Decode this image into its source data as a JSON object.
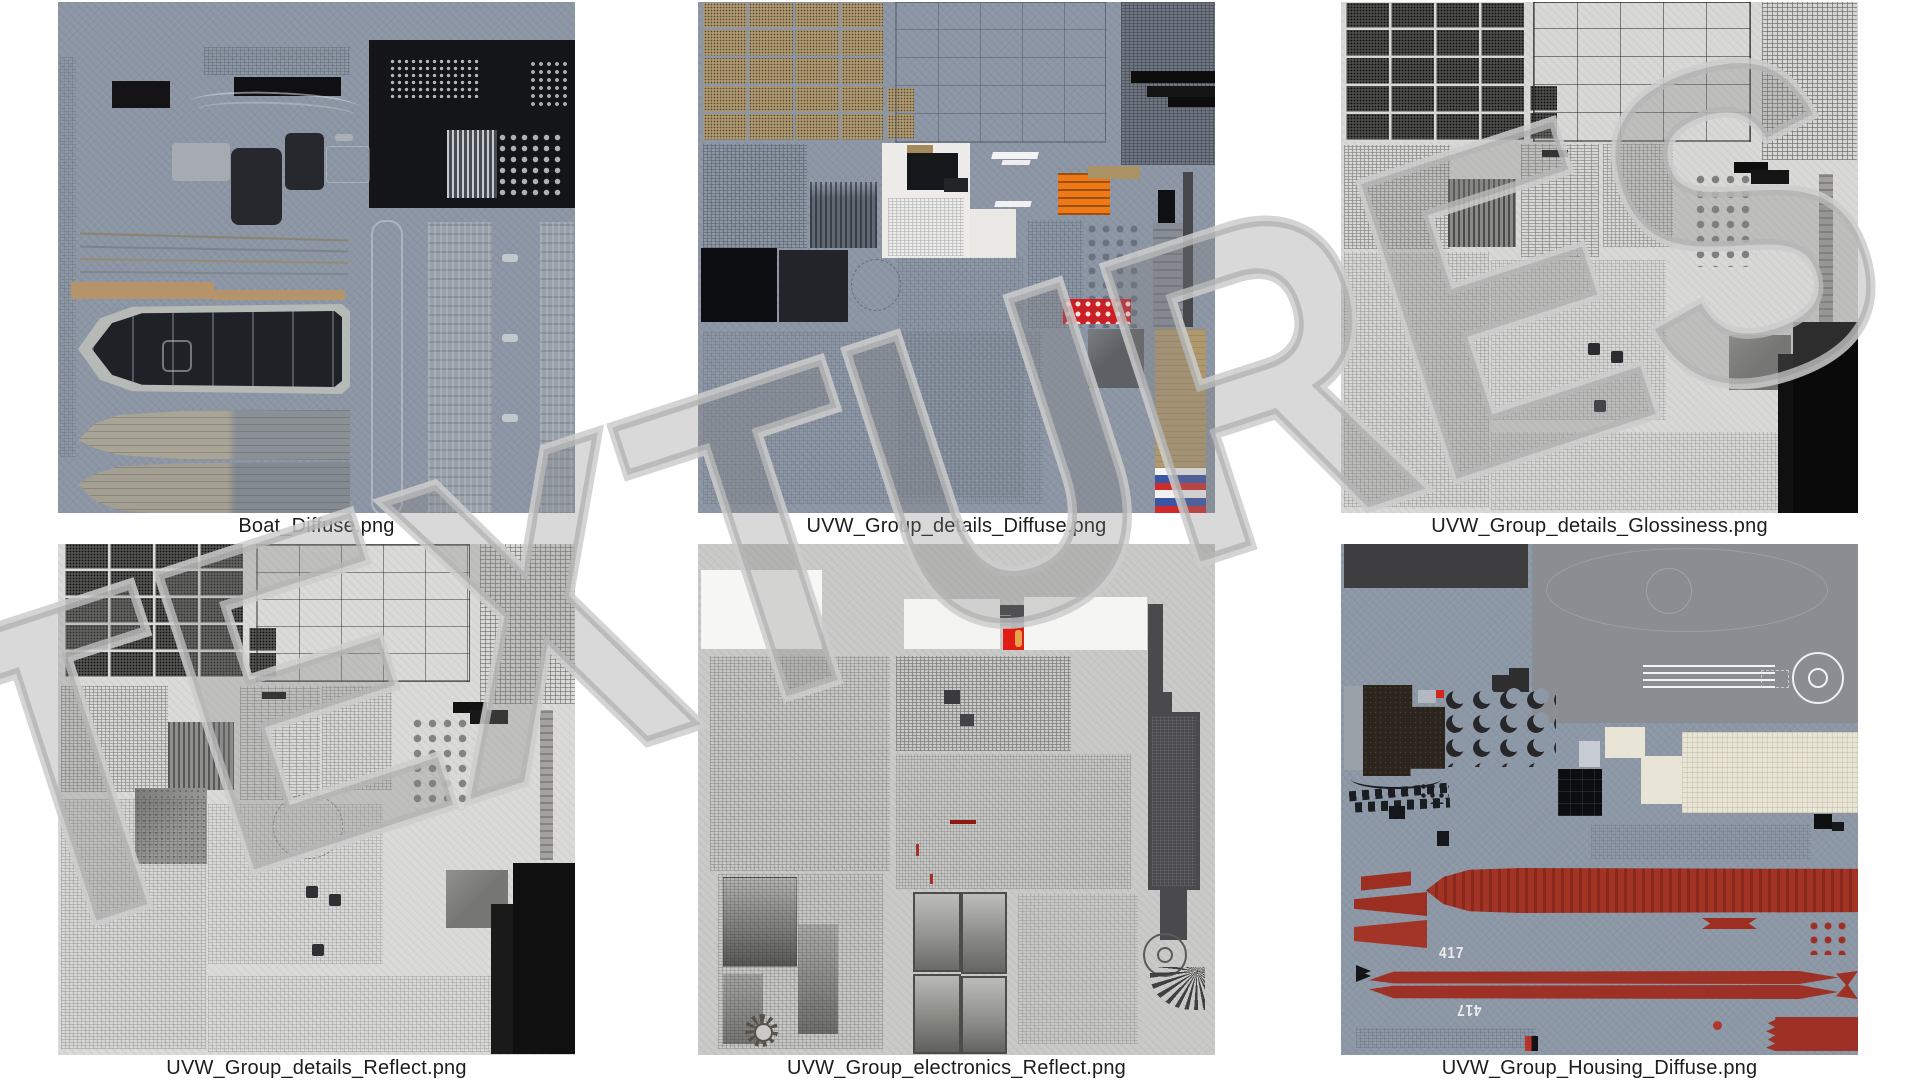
{
  "watermark": {
    "text": "TEXTURES"
  },
  "tiles": [
    {
      "name": "boat-diffuse",
      "label": "Boat_Diffuse.png"
    },
    {
      "name": "uvw-group-details-diffuse",
      "label": "UVW_Group_details_Diffuse.png"
    },
    {
      "name": "uvw-group-details-glossiness",
      "label": "UVW_Group_details_Glossiness.png"
    },
    {
      "name": "uvw-group-details-reflect",
      "label": "UVW_Group_details_Reflect.png"
    },
    {
      "name": "uvw-group-electronics-reflect",
      "label": "UVW_Group_electronics_Reflect.png"
    },
    {
      "name": "uvw-group-housing-diffuse",
      "label": "UVW_Group_Housing_Diffuse.png",
      "hull_number_decal": "417"
    }
  ],
  "colors": {
    "page_background": "#ffffff",
    "blue_gray_texture_background": "#8c96a4",
    "light_gray_texture_background": "#d8d8d6",
    "mid_gray_texture_background": "#c9c9c7",
    "tan_wood_strip": "#b5946c",
    "orange_patch": "#ee7916",
    "red_patch": "#c92026",
    "torpedo_red": "#9e3125",
    "flag_white": "#f4f4f4",
    "flag_blue": "#3b54a4",
    "flag_red": "#cf2b2b",
    "cream_patch": "#e9e5d6",
    "label_text": "#1c1c1c"
  }
}
